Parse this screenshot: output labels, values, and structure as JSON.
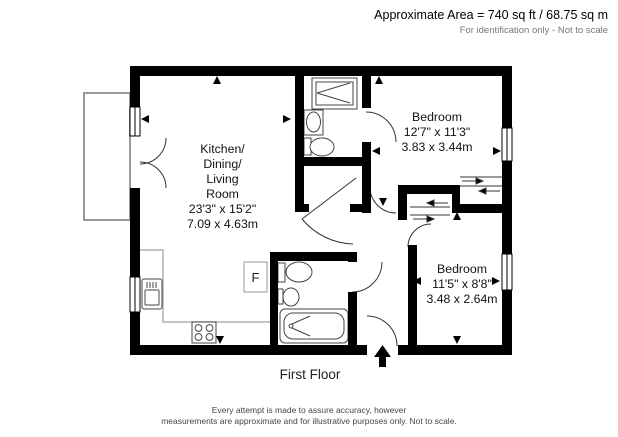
{
  "header": {
    "area_line": "Approximate Area = 740 sq ft / 68.75 sq m",
    "identification_line": "For identification only - Not to scale"
  },
  "rooms": {
    "living": {
      "name": "Kitchen/\nDining/\nLiving\nRoom",
      "dims_imperial": "23'3\" x 15'2\"",
      "dims_metric": "7.09 x 4.63m"
    },
    "bedroom1": {
      "name": "Bedroom",
      "dims_imperial": "12'7\" x 11'3\"",
      "dims_metric": "3.83 x 3.44m"
    },
    "bedroom2": {
      "name": "Bedroom",
      "dims_imperial": "11'5\" x 8'8\"",
      "dims_metric": "3.48 x 2.64m"
    }
  },
  "labels": {
    "fridge": "F",
    "floor_title": "First Floor"
  },
  "footer": {
    "line1": "Every attempt is made to assure accuracy, however",
    "line2": "measurements are approximate and for illustrative purposes only. Not to scale."
  },
  "colors": {
    "wall": "#000000",
    "fixture_outline": "#444444",
    "counter_outline": "#b0b0b0",
    "balcony_outline": "#999999",
    "muted_text": "#777777"
  }
}
